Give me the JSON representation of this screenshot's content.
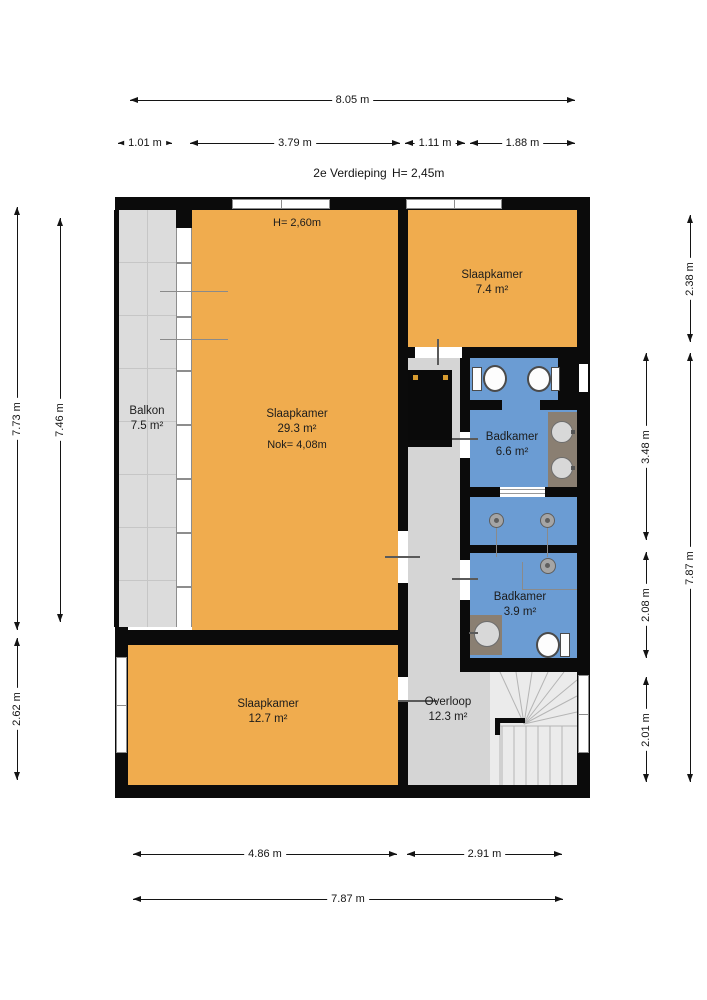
{
  "title": {
    "floor_label": "2e Verdieping",
    "floor_height": "H= 2,45m"
  },
  "rooms": [
    {
      "name": "Balkon",
      "area": "7.5 m²"
    },
    {
      "name": "Slaapkamer",
      "area": "29.3 m²",
      "ridge_height": "Nok= 4,08m",
      "ceiling_height": "H= 2,60m"
    },
    {
      "name": "Slaapkamer",
      "area": "7.4 m²"
    },
    {
      "name": "Badkamer",
      "area": "6.6 m²"
    },
    {
      "name": "Badkamer",
      "area": "3.9 m²"
    },
    {
      "name": "Slaapkamer",
      "area": "12.7 m²"
    },
    {
      "name": "Overloop",
      "area": "12.3 m²"
    }
  ],
  "dimensions": {
    "top": {
      "total": "8.05 m",
      "segments": [
        "1.01 m",
        "3.79 m",
        "1.11 m",
        "1.88 m"
      ]
    },
    "bottom": {
      "total": "7.87 m",
      "segments": [
        "4.86 m",
        "2.91 m"
      ]
    },
    "left": {
      "outer": "7.73 m",
      "inner": "7.46 m",
      "lower": "2.62 m"
    },
    "right": {
      "top": "2.38 m",
      "total": "7.87 m",
      "segments": [
        "3.48 m",
        "2.08 m",
        "2.01 m"
      ]
    }
  },
  "colors": {
    "room_orange": "#F0AC4E",
    "bathroom_blue": "#6B9CD3",
    "floor_gray": "#D5D5D5",
    "balcony_gray": "#DCDCDC",
    "stairs_gray": "#EBEBEB",
    "wall_black": "#0B0B0B",
    "counter_taupe": "#8A7F72",
    "shaft_dot_yellow": "#D79B2F"
  }
}
